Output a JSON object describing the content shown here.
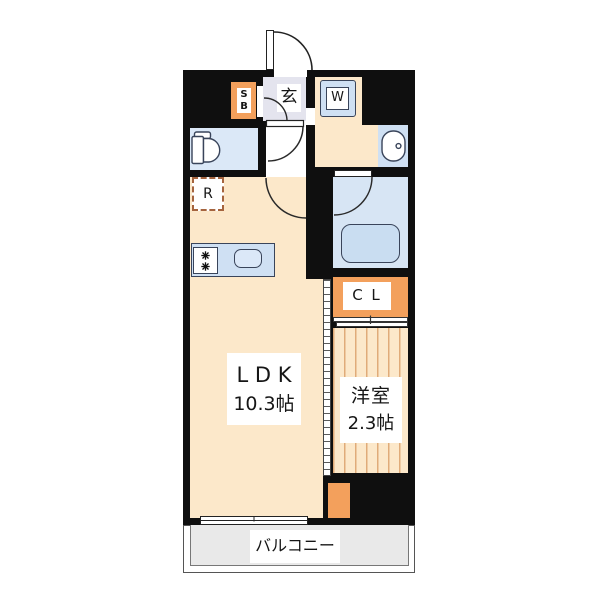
{
  "unit": {
    "entrance": {
      "label": "玄"
    },
    "shoe_box": {
      "line1": "S",
      "line2": "B"
    },
    "washer": {
      "label": "W"
    },
    "refrigerator": {
      "label": "R"
    },
    "closet": {
      "label": "C L"
    },
    "ldk": {
      "name": "L D K",
      "size": "10.3帖"
    },
    "western_room": {
      "name": "洋室",
      "size": "2.3帖"
    },
    "balcony": {
      "label": "バルコニー"
    }
  },
  "colors": {
    "wall": "#0f0f0f",
    "floor_peach": "#fce8ca",
    "accent_orange": "#f3a05c",
    "water_blue": "#cfe0f3",
    "toilet_blue": "#dbe8f7",
    "bath_blue": "#d7e5f4",
    "tub_blue": "#c9ddf1",
    "sink_blue": "#dbe8f8",
    "genkan_gray": "#e4e4ee",
    "balcony_gray": "#e9e9e9",
    "stripe_tan": "#e0ab79",
    "fixture_outline": "#39445a",
    "fridge_dash": "#a5643e"
  }
}
